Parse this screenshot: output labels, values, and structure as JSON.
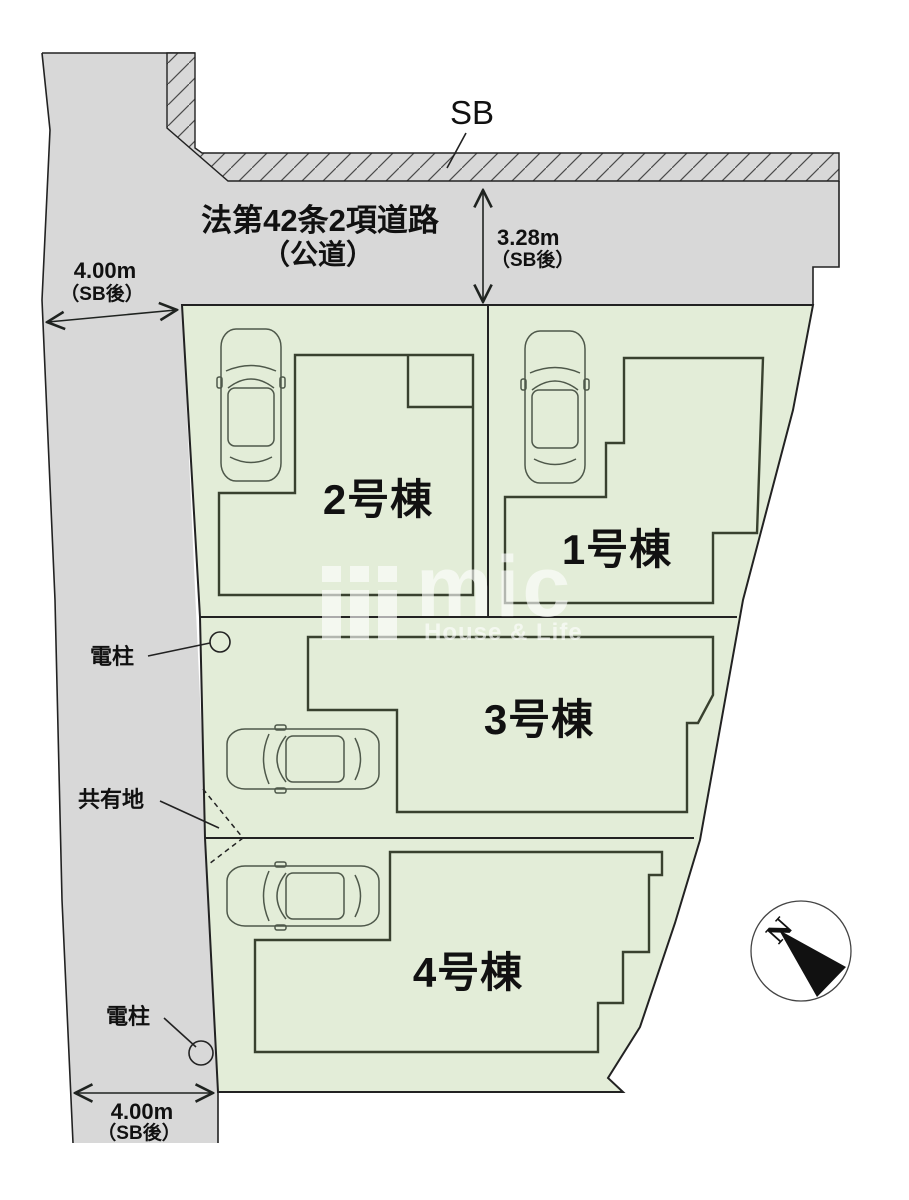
{
  "colors": {
    "road_gray": "#d8d8d8",
    "site_green": "#e3edd8",
    "boundary_line": "#222222",
    "building_line": "#39412f",
    "car_line": "#4e584a",
    "watermark_white": "#ffffff"
  },
  "road": {
    "label_line1": "法第42条2項道路",
    "label_line2": "（公道）",
    "sb_label": "SB"
  },
  "dimensions": {
    "west_width": {
      "value": "4.00m",
      "note": "（SB後）"
    },
    "north_depth": {
      "value": "3.28m",
      "note": "（SB後）"
    },
    "south_width": {
      "value": "4.00m",
      "note": "（SB後）"
    }
  },
  "plots": [
    {
      "id": "1",
      "label": "1号棟"
    },
    {
      "id": "2",
      "label": "2号棟"
    },
    {
      "id": "3",
      "label": "3号棟"
    },
    {
      "id": "4",
      "label": "4号棟"
    }
  ],
  "annotations": {
    "utility_pole_north": "電柱",
    "shared_area": "共有地",
    "utility_pole_south": "電柱"
  },
  "compass": {
    "north": "N"
  },
  "watermark": {
    "logo_text": "mic",
    "tagline": "House & Life"
  }
}
